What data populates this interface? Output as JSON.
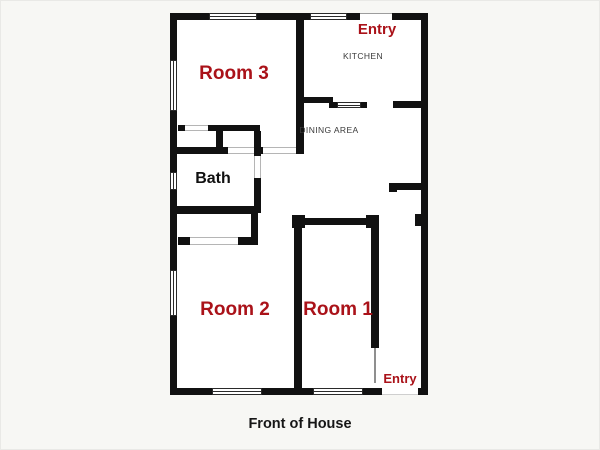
{
  "colors": {
    "wall": "#111111",
    "label_red": "#aa1219",
    "floor": "#ffffff",
    "canvas": "#f7f7f4",
    "small_text": "#3a3a3a"
  },
  "rooms": {
    "room3": {
      "label": "Room 3"
    },
    "kitchen": {
      "label": "KITCHEN"
    },
    "dining": {
      "label": "DINING AREA"
    },
    "bath": {
      "label": "Bath"
    },
    "room2": {
      "label": "Room 2"
    },
    "room1": {
      "label": "Room 1"
    }
  },
  "entries": {
    "top": {
      "label": "Entry"
    },
    "bottom": {
      "label": "Entry"
    }
  },
  "caption": "Front of House"
}
